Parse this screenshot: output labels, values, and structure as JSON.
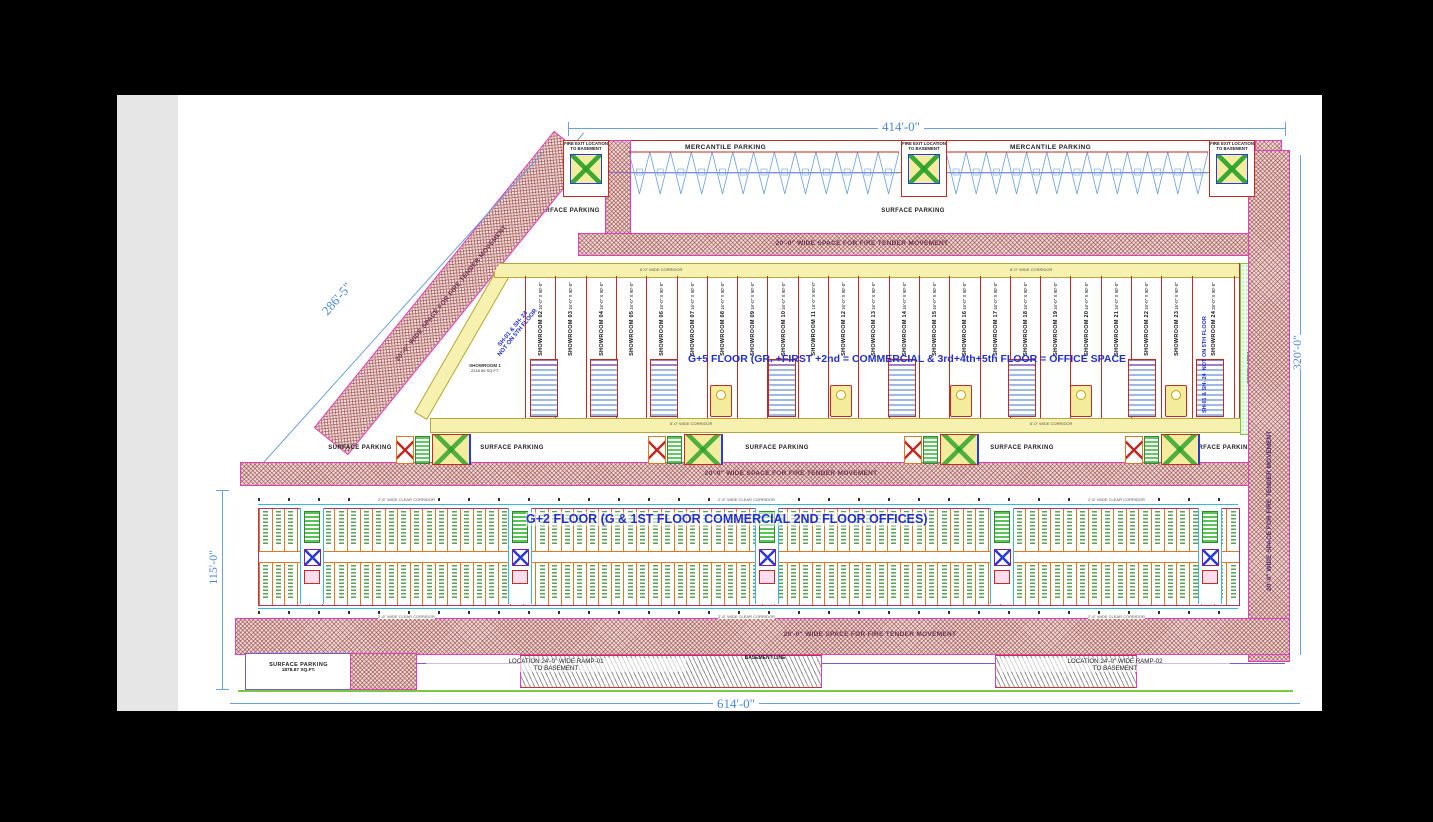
{
  "dimensions": {
    "top": "414'-0\"",
    "bottom": "614'-0\"",
    "left_height": "115'-0\"",
    "left_diagonal": "286'-5\"",
    "right_height": "320'-0\""
  },
  "annotations": {
    "g5_floor": "G+5 FLOOR  (GR. +FIRST +2nd = COMMERCIAL & 3rd+4th+5th FLOOR = OFFICE SPACE",
    "g2_floor": "G+2 FLOOR  (G & 1ST FLOOR COMMERCIAL 2ND FLOOR OFFICES)",
    "sh_note_line1": "SH-01 & SH- 24",
    "sh_note_line2": "NOT ON 5TH FLOOR",
    "green_area": "GREEN AREA",
    "fire_tender_space": "20'-0\" WIDE SPACE FOR FIRE TENDER MOVEMENT",
    "basement_line": "BASEMENT LINE",
    "mercantile_parking": "MERCANTILE PARKING",
    "surface_parking": "SURFACE  PARKING",
    "surface_parking_area": "1878.87 SQ.FT.",
    "fire_exit": "FIRE EXIT LOCATION TO BASEMENT",
    "ramp1_line1": "LOCATION  24'-0\" WIDE RAMP-01",
    "ramp2_line1": "LOCATION  24'-0\" WIDE RAMP-02",
    "ramp_line2": "TO BASEMENT",
    "corridor_8": "8'-0\" WIDE CORRIDOR",
    "corridor_26": "2'-6\" WIDE CLEAR CORRIDOR",
    "showroom1_name": "SHOWROOM 1",
    "showroom1_area": "2218.56 SQ.FT."
  },
  "showrooms": [
    {
      "name": "SHOWROOM 02",
      "size": "16'-0\" X 90'-0\""
    },
    {
      "name": "SHOWROOM 03",
      "size": "16'-0\" X 90'-0\""
    },
    {
      "name": "SHOWROOM 04",
      "size": "16'-0\" X 90'-0\""
    },
    {
      "name": "SHOWROOM 05",
      "size": "16'-0\" X 90'-0\""
    },
    {
      "name": "SHOWROOM 06",
      "size": "16'-0\" X 90'-0\""
    },
    {
      "name": "SHOWROOM 07",
      "size": "16'-0\" X 90'-0\""
    },
    {
      "name": "SHOWROOM 08",
      "size": "16'-0\" X 90'-0\""
    },
    {
      "name": "SHOWROOM 09",
      "size": "16'-0\" X 90'-0\""
    },
    {
      "name": "SHOWROOM 10",
      "size": "16'-0\" X 90'-0\""
    },
    {
      "name": "SHOWROOM 11",
      "size": "16'-0\" X 90'-0\""
    },
    {
      "name": "SHOWROOM 12",
      "size": "16'-0\" X 90'-0\""
    },
    {
      "name": "SHOWROOM 13",
      "size": "16'-0\" X 90'-0\""
    },
    {
      "name": "SHOWROOM 14",
      "size": "16'-0\" X 90'-0\""
    },
    {
      "name": "SHOWROOM 15",
      "size": "16'-0\" X 90'-0\""
    },
    {
      "name": "SHOWROOM 16",
      "size": "16'-0\" X 90'-0\""
    },
    {
      "name": "SHOWROOM 17",
      "size": "16'-0\" X 90'-0\""
    },
    {
      "name": "SHOWROOM 18",
      "size": "16'-0\" X 90'-0\""
    },
    {
      "name": "SHOWROOM 19",
      "size": "16'-0\" X 90'-0\""
    },
    {
      "name": "SHOWROOM 20",
      "size": "16'-0\" X 90'-0\""
    },
    {
      "name": "SHOWROOM 21",
      "size": "16'-0\" X 90'-0\""
    },
    {
      "name": "SHOWROOM 22",
      "size": "16'-0\" X 90'-0\""
    },
    {
      "name": "SHOWROOM 23",
      "size": "16'-0\" X 90'-0\""
    },
    {
      "name": "SHOWROOM 24",
      "size": "28'-0\" X 90'-0\""
    }
  ],
  "colors": {
    "dimension_blue": "#4a86d8",
    "annotation_blue": "#2330c8",
    "hatch_red": "#9c4a45",
    "corridor_yellow": "#f6f1ae",
    "wall_red": "#c22a22",
    "magenta": "#e23cc0",
    "purple": "#6b3fa0",
    "cyan": "#35b8e8",
    "orange": "#e07820",
    "green": "#2e8b2e"
  }
}
